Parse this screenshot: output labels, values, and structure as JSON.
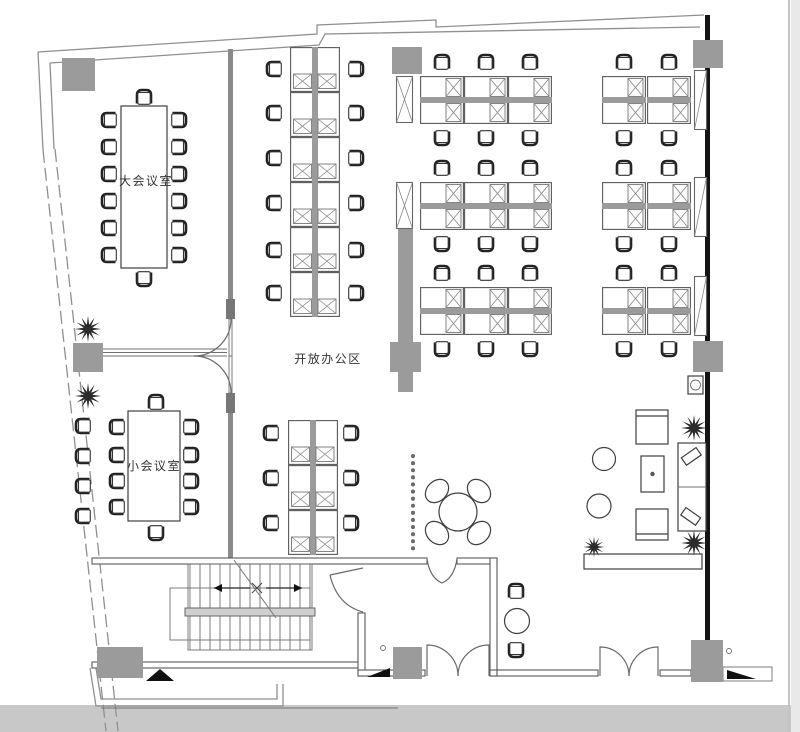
{
  "rooms": {
    "large_meeting": {
      "label": "大会议室"
    },
    "small_meeting": {
      "label": "小会议室"
    },
    "open_office": {
      "label": "开放办公区"
    }
  },
  "colors": {
    "background": "#ffffff",
    "photo_band": "#c8c8c8",
    "photo_edge": "#e9e9e9",
    "wall": "#909090",
    "wall_dark": "#141414",
    "column": "#9b9b9b",
    "furniture_line": "#3f3f3f",
    "desk_spine": "#9b9b9b",
    "plant": "#2b2b2b",
    "text": "#333333"
  },
  "icons": {
    "plant": "plant-starburst",
    "chair": "office-chair-top-view",
    "stairs": "staircase-direction-arrows",
    "door": "door-swing-arc"
  }
}
